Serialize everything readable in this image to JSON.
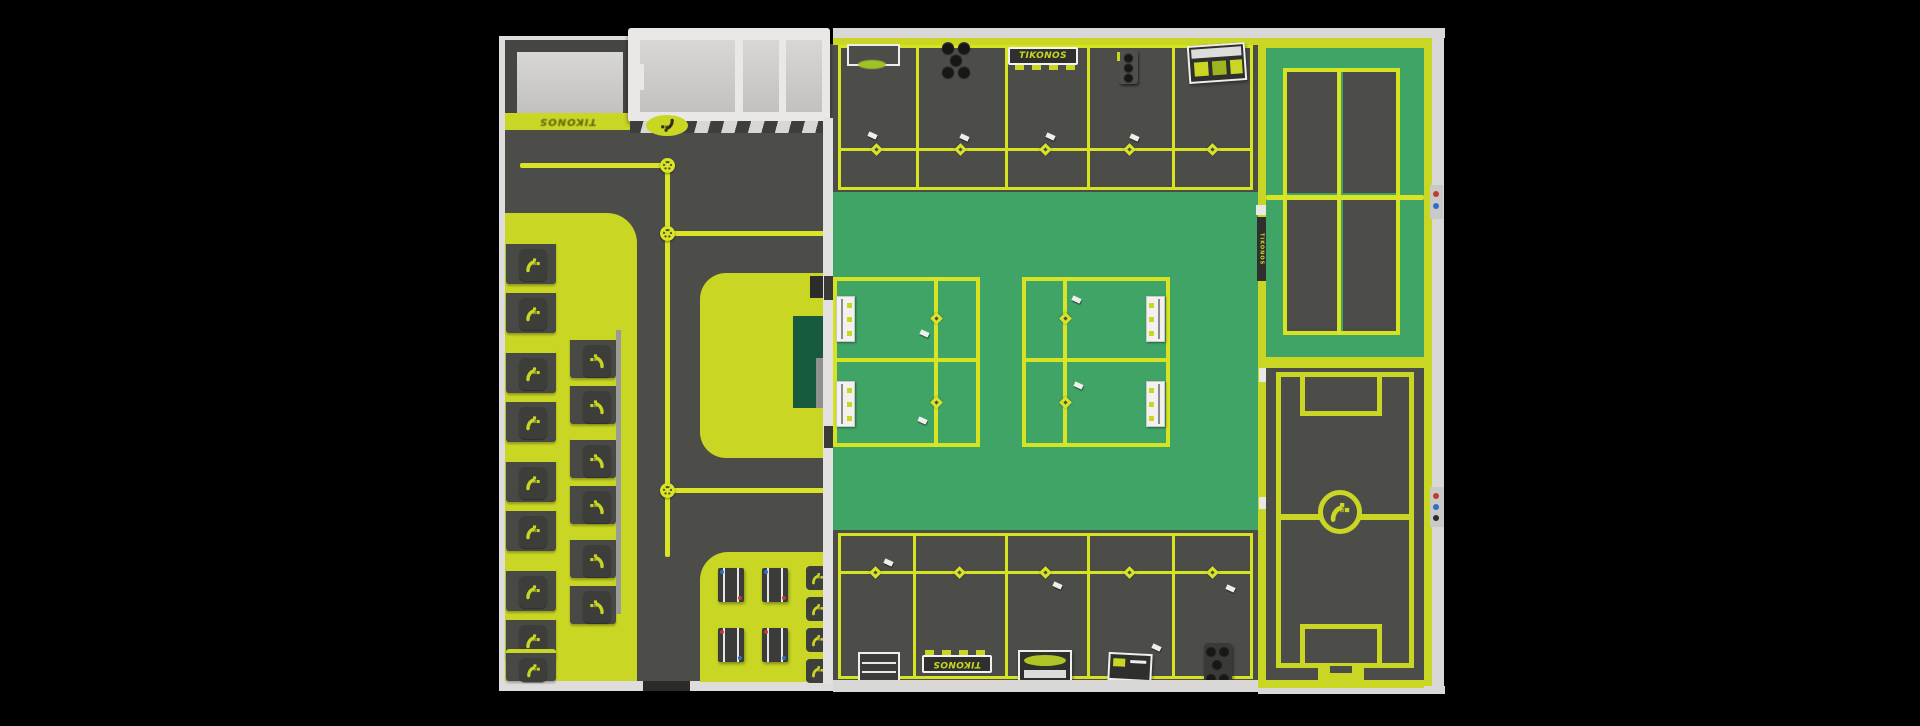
{
  "brand": "TIKONOS",
  "signs": {
    "top_row_sign": "TIKONOS",
    "bottom_row_sign": "TIKONOS",
    "entry_stripe_sign": "TIKONOS",
    "divider_wall_banner": "TIKONOS"
  },
  "palette": {
    "background": "#000000",
    "floor_dark": "#4c4c49",
    "accent_chartreuse": "#c9d724",
    "path_line_yellow": "#d9e427",
    "court_green": "#3fa465",
    "stage_dark_green": "#175a3e",
    "wall_white": "#dedddb",
    "room_floor_gray": "#cccbc9",
    "equipment_dark": "#3a3a38",
    "marker_red": "#c43a2e",
    "marker_blue": "#2f6fc1"
  },
  "icons": {
    "brand_glyph": "tikonos-pixel-swoosh-icon",
    "path_node": "circular-junction-node-icon",
    "stall_node": "diamond-junction-node-icon",
    "center_circle_logo": "tikonos-pixel-swoosh-icon"
  },
  "counts": {
    "left_wall_lockers": 9,
    "inner_lockers": 6,
    "treadmills": 4,
    "top_stalls": 5,
    "bottom_stalls": 5,
    "padel_quadrants": 4,
    "center_courts": 4
  }
}
